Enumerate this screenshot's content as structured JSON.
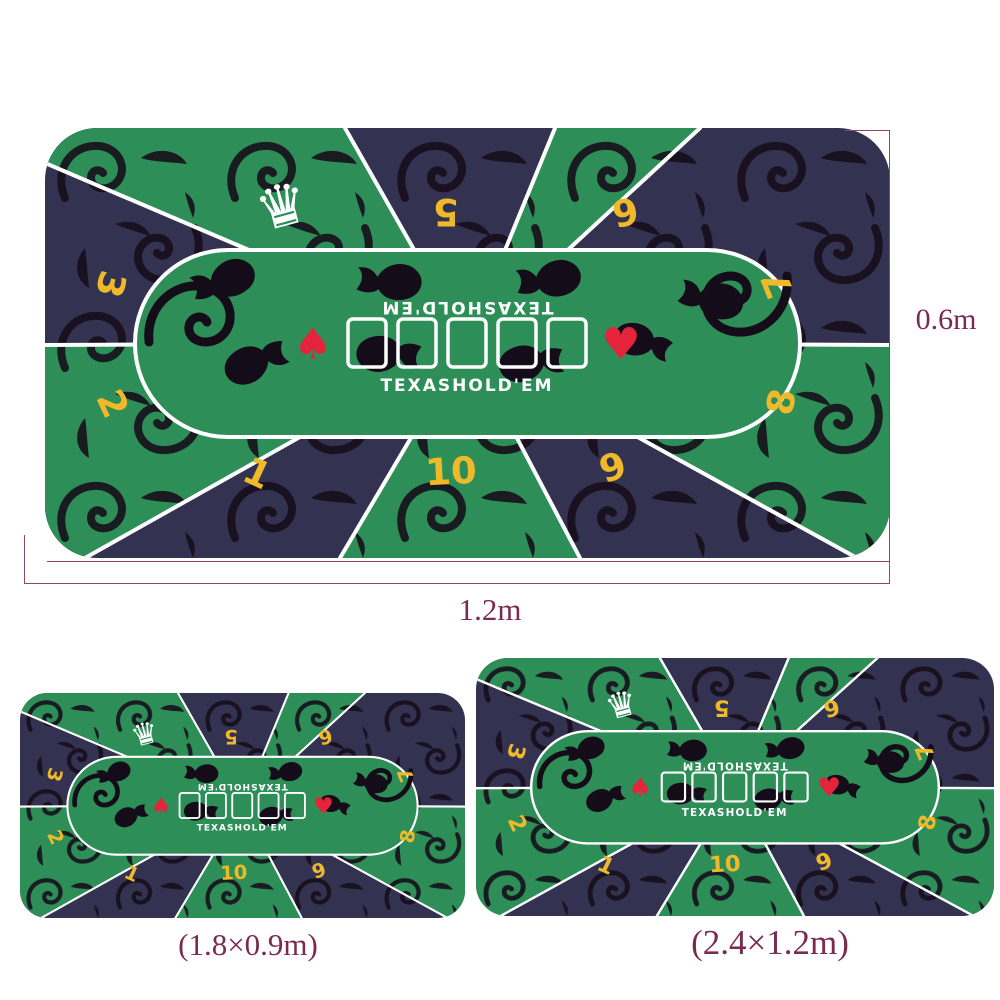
{
  "product": {
    "brand_text_top_reversed": "TEXASHOLD'EM",
    "brand_text_bottom": "TEXASHOLD'EM",
    "seat_numbers": [
      "1",
      "2",
      "3",
      "5",
      "6",
      "7",
      "8",
      "9",
      "10"
    ],
    "crown_icon": "♛",
    "suit_left_icon": "♠",
    "suit_right_icon": "♥",
    "card_slots": 5
  },
  "annotations": {
    "height_label": "0.6m",
    "width_label": "1.2m",
    "caption_medium": "(1.8×0.9m)",
    "caption_xlarge": "(2.4×1.2m)"
  },
  "colors": {
    "felt_green": "#2e8e58",
    "felt_navy": "#333251",
    "pattern_black": "#150c19",
    "seat_number_yellow": "#f0b929",
    "suit_red": "#e3243b",
    "line_white": "#ffffff",
    "annotation_maroon": "#7a2b50"
  }
}
